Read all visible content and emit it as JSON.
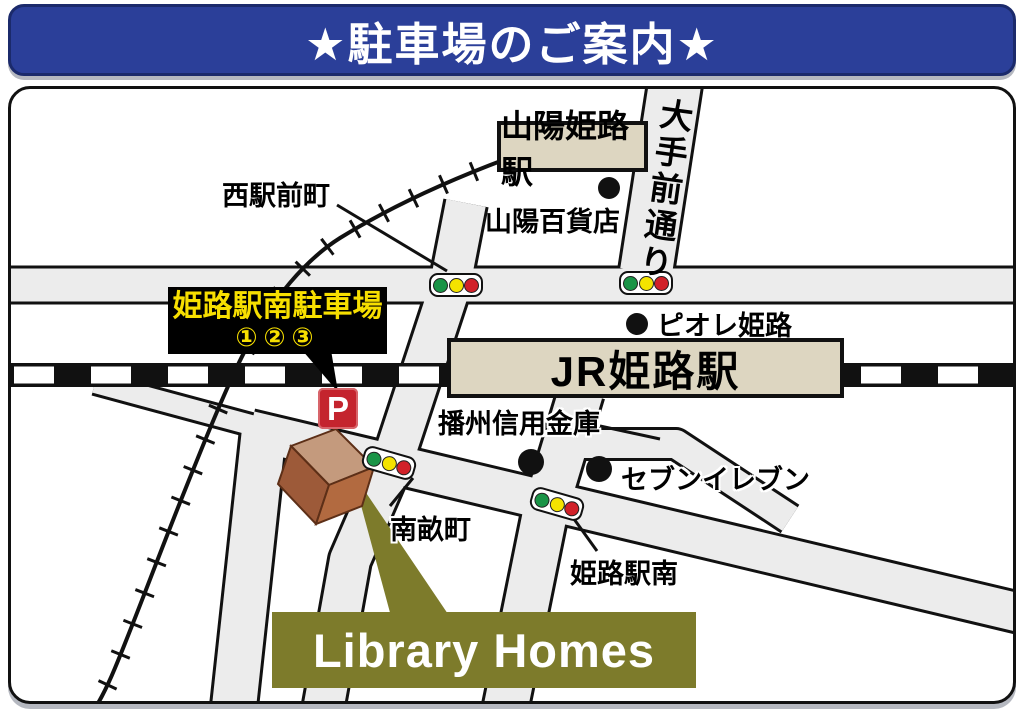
{
  "banner": {
    "title": "★駐車場のご案内★"
  },
  "map": {
    "stations": {
      "sanyo": "山陽姫路駅",
      "jr": "JR姫路駅"
    },
    "roads": {
      "otemae": "大手前通り"
    },
    "areas": {
      "nishiekimae": "西駅前町",
      "nanaze": "南畝町",
      "himejieki_minami": "姫路駅南"
    },
    "pois": {
      "sanyo_dept": "山陽百貨店",
      "piole": "ピオレ姫路",
      "banshu": "播州信用金庫",
      "seven": "セブンイレブン"
    },
    "parking_callout": {
      "line1": "姫路駅南駐車場",
      "line2": "①②③"
    },
    "parking_icon": "P",
    "library_homes": "Library Homes",
    "colors": {
      "banner_blue": "#2b3f99",
      "road_gray": "#ececec",
      "station_beige": "#ddd6c1",
      "library_olive": "#7d7b2b",
      "parking_red": "#c4242e",
      "callout_text_yellow": "#f7df00",
      "signal_green": "#1a9447",
      "signal_yellow": "#f4e300",
      "signal_red": "#d12129",
      "building_top": "#c49a7d",
      "building_left": "#9d5a39",
      "building_right": "#b26a40"
    }
  }
}
